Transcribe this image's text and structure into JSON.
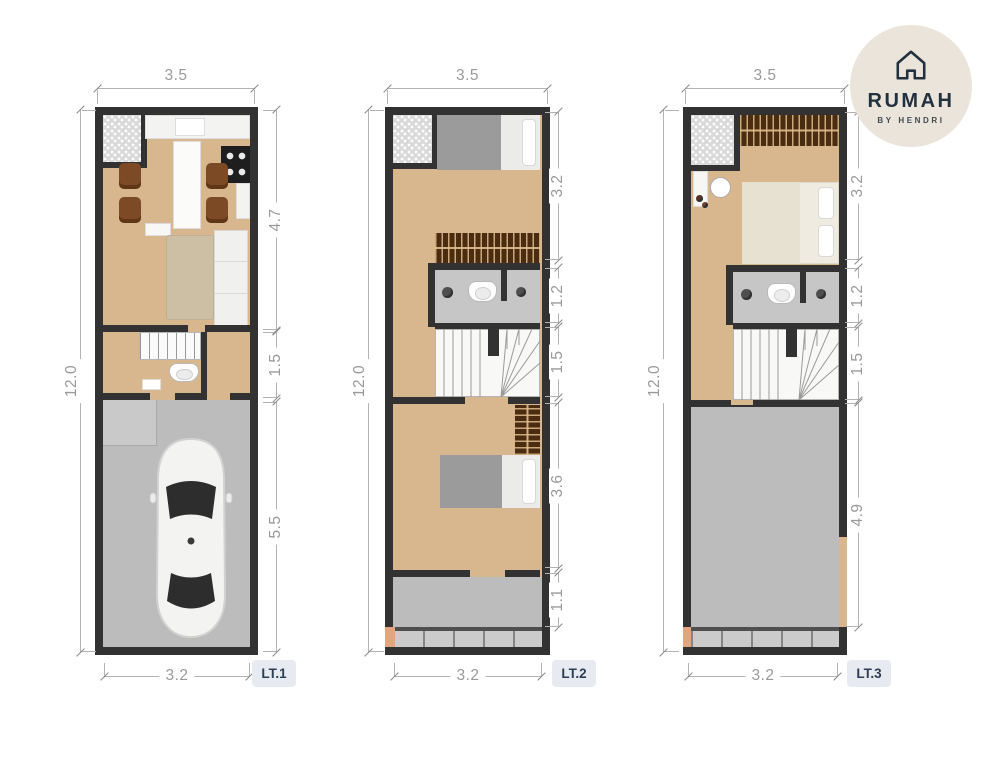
{
  "logo": {
    "brand": "RUMAH",
    "tagline": "BY HENDRI"
  },
  "plans": [
    {
      "label": "LT.1",
      "top": "3.5",
      "left": "12.0",
      "bottom": "3.2",
      "right": [
        "4.7",
        "1.5",
        "5.5"
      ]
    },
    {
      "label": "LT.2",
      "top": "3.5",
      "left": "12.0",
      "bottom": "3.2",
      "right": [
        "3.2",
        "1.2",
        "1.5",
        "3.6",
        "1.1"
      ]
    },
    {
      "label": "LT.3",
      "top": "3.5",
      "left": "12.0",
      "bottom": "3.2",
      "right": [
        "3.2",
        "1.2",
        "1.5",
        "4.9"
      ]
    }
  ],
  "colors": {
    "wall": "#323232",
    "wood": "#d9b78e",
    "garage": "#bcbcbc",
    "bath": "#c6c6c6",
    "hatch": "#d9d9d9",
    "wardrobe": "#4a2c11",
    "blanket": "#9b9b9b",
    "sofa": "#cdbfa4",
    "chair": "#7c4b26",
    "peach": "#e2a57e",
    "dimline": "#b3b3b3",
    "dimtext": "#9a9a9a",
    "badgebg": "#e7eaf0",
    "badgetext": "#2c3e55",
    "logobg": "#eae4da",
    "logoink": "#22313f"
  }
}
